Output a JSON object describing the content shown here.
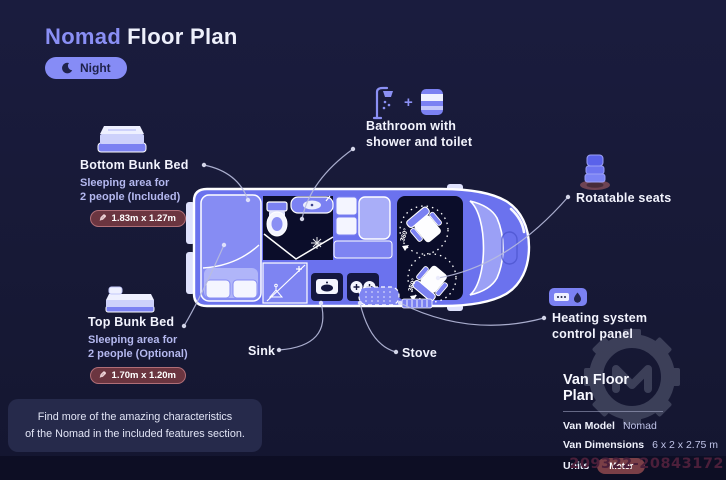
{
  "header": {
    "title_brand": "Nomad",
    "title_rest": "Floor Plan",
    "mode_label": "Night"
  },
  "callouts": {
    "bottom_bunk": {
      "title": "Bottom Bunk Bed",
      "desc1": "Sleeping area for",
      "desc2": "2 people (Included)",
      "dimensions": "1.83m x 1.27m"
    },
    "top_bunk": {
      "title": "Top Bunk Bed",
      "desc1": "Sleeping area for",
      "desc2": "2 people (Optional)",
      "dimensions": "1.70m x 1.20m"
    },
    "bathroom": {
      "line1": "Bathroom with",
      "line2": "shower and toilet",
      "plus": "+"
    },
    "rotatable_seats": {
      "label": "Rotatable seats"
    },
    "heating": {
      "line1": "Heating system",
      "line2": "control panel"
    },
    "sink": {
      "label": "Sink"
    },
    "stove": {
      "label": "Stove"
    }
  },
  "floor_plan": {
    "rotation_label_1": "360°",
    "rotation_label_2": "360°"
  },
  "info_panel": {
    "heading": "Van Floor Plan",
    "model_label": "Van Model",
    "model_value": "Nomad",
    "dimensions_label": "Van Dimensions",
    "dimensions_value": "6 x 2 x 2.75 m",
    "units_label": "Units",
    "units_value": "Meter"
  },
  "footer_note": {
    "line1": "Find more of the amazing characteristics",
    "line2": "of the Nomad in the included features section."
  },
  "watermark": {
    "id_number": "209322-20843172"
  },
  "colors": {
    "background": "#171936",
    "van_body": "#6b72ee",
    "accent_periwinkle": "#868cf6",
    "interior_dark": "#0b0d2a",
    "badge_maroon": "#6b3540",
    "badge_border": "#b06e77",
    "text_muted": "#b4b8ef",
    "watermark_number": "#4b1f3a",
    "gear_grey": "#8d93a8"
  }
}
